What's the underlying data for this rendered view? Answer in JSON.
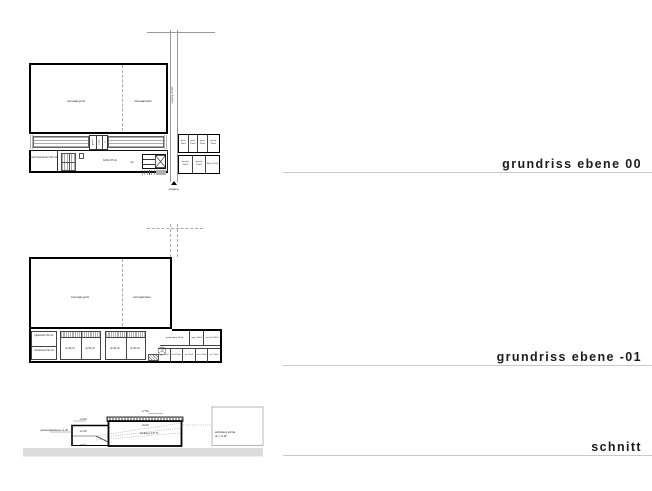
{
  "titles": {
    "plan00": "grundriss ebene 00",
    "plan01": "grundriss ebene -01",
    "schnitt": "schnitt"
  },
  "plan00": {
    "hall_large": "turnsaal groß",
    "hall_small": "turnsaal klein",
    "corridor": "zugang schule",
    "strip_rooms": [
      "geräte",
      "regie",
      "wc"
    ],
    "room_left": "mehrzweckraum 60 m2",
    "buffet": "buffet 37m2",
    "wc": "wc",
    "right_top_rooms": [
      "gard. 15m2",
      "gard. 15m2",
      "gard. 15m2",
      "geräte 25m2"
    ],
    "right_bottom_rooms": [
      "dusche 15m2",
      "dusche 15m2",
      "lehrer 27m2"
    ],
    "entrance": "eingang"
  },
  "plan01": {
    "hall_large": "turnsaal groß",
    "hall_small": "turnsaal klein",
    "room_left_top": "garderoben 60 m2",
    "room_left_bottom": "theorieraum 60 m2",
    "lockers": [
      "uk 35 m2",
      "uk 35 m2",
      "uk 35 m2",
      "uk 35 m2"
    ],
    "right_top_rooms": [
      "garderoben 50m2",
      "regie 15m2",
      "technik 25m2"
    ],
    "right_bottom_rooms": [
      "lager 10m2",
      "wc-d 15m2",
      "wc 15m2",
      "wc-h 15m2",
      "e.k. 15m2"
    ]
  },
  "schnitt": {
    "level_roof_top": "+7.50",
    "level_roof_bottom": "+6.00",
    "slope": "senkung 4.27 %",
    "level_left_top": "+3.00",
    "level_plateau": "+1.20",
    "plateau_label": "pausenplatzebene +1.20",
    "level_zero": "0.00",
    "level_floor": "-1.00",
    "link_line1": "anbindung schule",
    "link_line2": "ok = -0.26"
  }
}
